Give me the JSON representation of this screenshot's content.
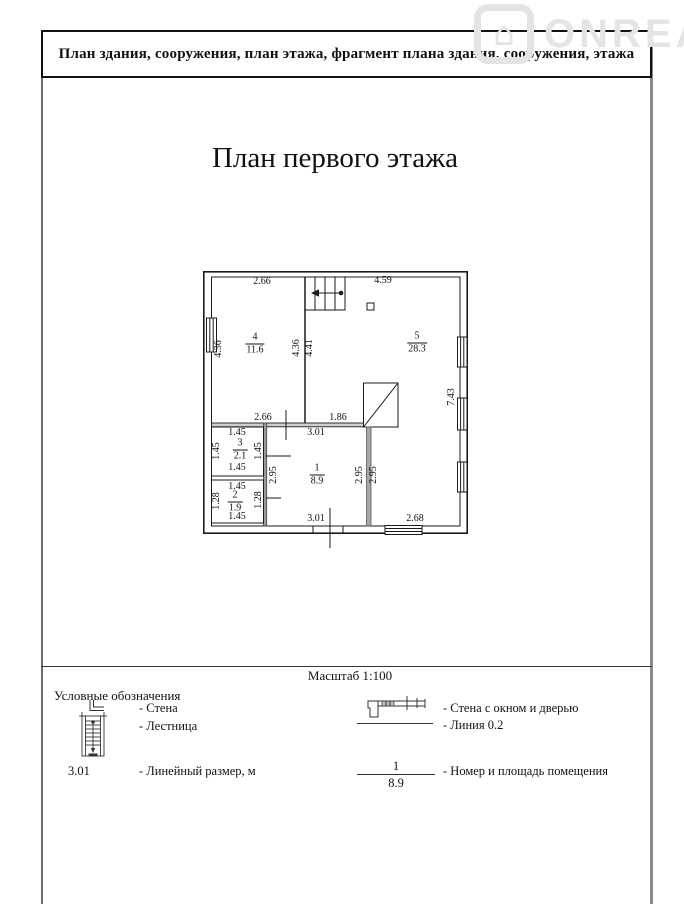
{
  "watermark": {
    "text": "ONREAL"
  },
  "header": {
    "title": "План здания, сооружения, план этажа, фрагмент плана здания, сооружения, этажа"
  },
  "plan": {
    "title": "План первого этажа",
    "scale": "Масштаб 1:100",
    "rooms": {
      "r1": {
        "num": "1",
        "area": "8.9"
      },
      "r2": {
        "num": "2",
        "area": "1.9"
      },
      "r3": {
        "num": "3",
        "area": "2.1"
      },
      "r4": {
        "num": "4",
        "area": "11.6"
      },
      "r5": {
        "num": "5",
        "area": "28.3"
      }
    },
    "dims": {
      "room4_width": "2.66",
      "room5_width": "4.59",
      "room4_height": "4.36",
      "hall_height_left": "4.36",
      "hall_height_right": "4.41",
      "right_total": "7.43",
      "hall_width_left": "2.66",
      "hall_width_right": "1.86",
      "room3_top": "1.45",
      "room3_left": "1.45",
      "room3_right": "1.45",
      "room3_bottom": "1.45",
      "room2_top": "1.45",
      "room2_left": "1.28",
      "room2_right": "1.28",
      "room2_bottom": "1.45",
      "room1_top": "3.01",
      "room1_left": "2.95",
      "room1_right_a": "2.95",
      "room1_right_b": "2.95",
      "room1_bottom": "3.01",
      "bottom_right": "2.68"
    }
  },
  "legend": {
    "title": "Условные обозначения",
    "wall": "- Стена",
    "stairs": "- Лестница",
    "linear_value": "3.01",
    "linear": "- Линейный размер, м",
    "wall_window_door": "- Стена с окном и дверью",
    "line": "- Линия 0.2",
    "room_num": "1",
    "room_area": "8.9",
    "room": "- Номер и площадь помещения"
  }
}
